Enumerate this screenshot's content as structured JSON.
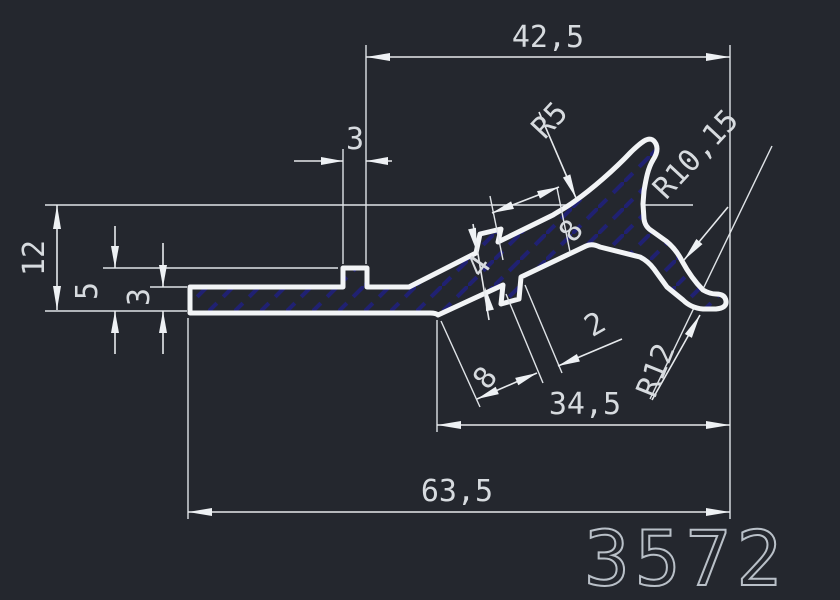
{
  "drawing": {
    "part_number": "3572",
    "dimensions": {
      "overall_top_width": "42,5",
      "bump_width": "3",
      "total_height": "12",
      "step_height": "5",
      "base_thickness": "3",
      "web_thickness": "4",
      "web_upper_length": "8",
      "web_lower_length": "8",
      "tooth_width": "2",
      "mid_width": "34,5",
      "overall_width": "63,5",
      "radius_tip": "R5",
      "radius_throat": "R10,15",
      "radius_hook": "R12"
    },
    "colors": {
      "background": "#24272e",
      "outline": "#f2f4f6",
      "dimension_line": "#e6e9ec",
      "text": "#d7dbdf",
      "hatch": "#20207a",
      "part_number_stroke": "#b9c0c8"
    }
  }
}
